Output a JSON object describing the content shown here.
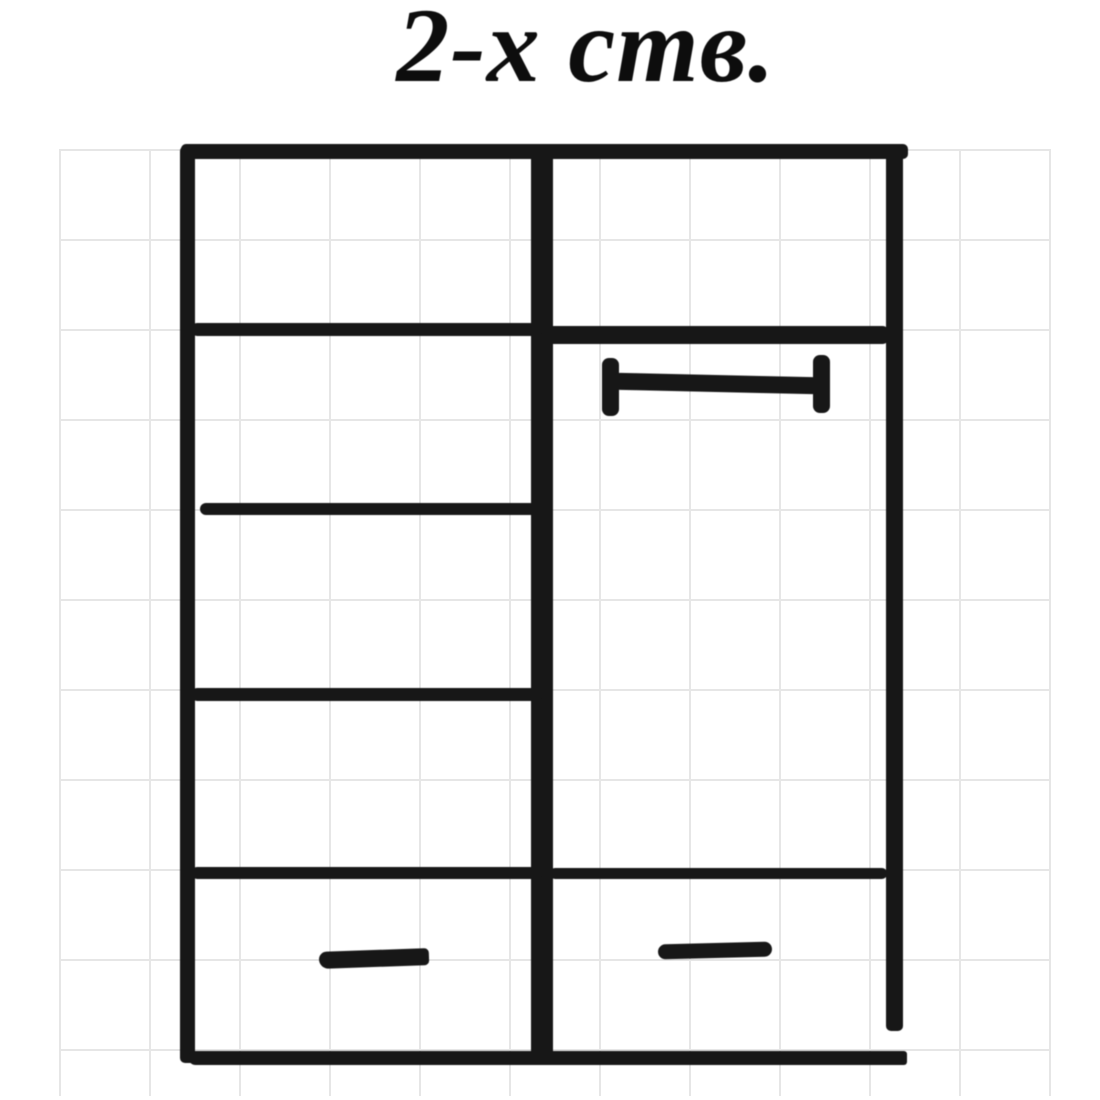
{
  "title": "2-х ств.",
  "colors": {
    "paper": "#ffffff",
    "ink": "#171717",
    "grid": "#c4c4c4"
  },
  "figure": {
    "subject": "hand-drawn front-view sketch of a two-door wardrobe",
    "left_column": {
      "shelf_lines": 3,
      "drawers": 1,
      "drawer_handle": "short dash"
    },
    "right_column": {
      "doors": 1,
      "door_handle": "horizontal bar with end caps",
      "drawers": 1,
      "drawer_handle": "short dash"
    }
  }
}
